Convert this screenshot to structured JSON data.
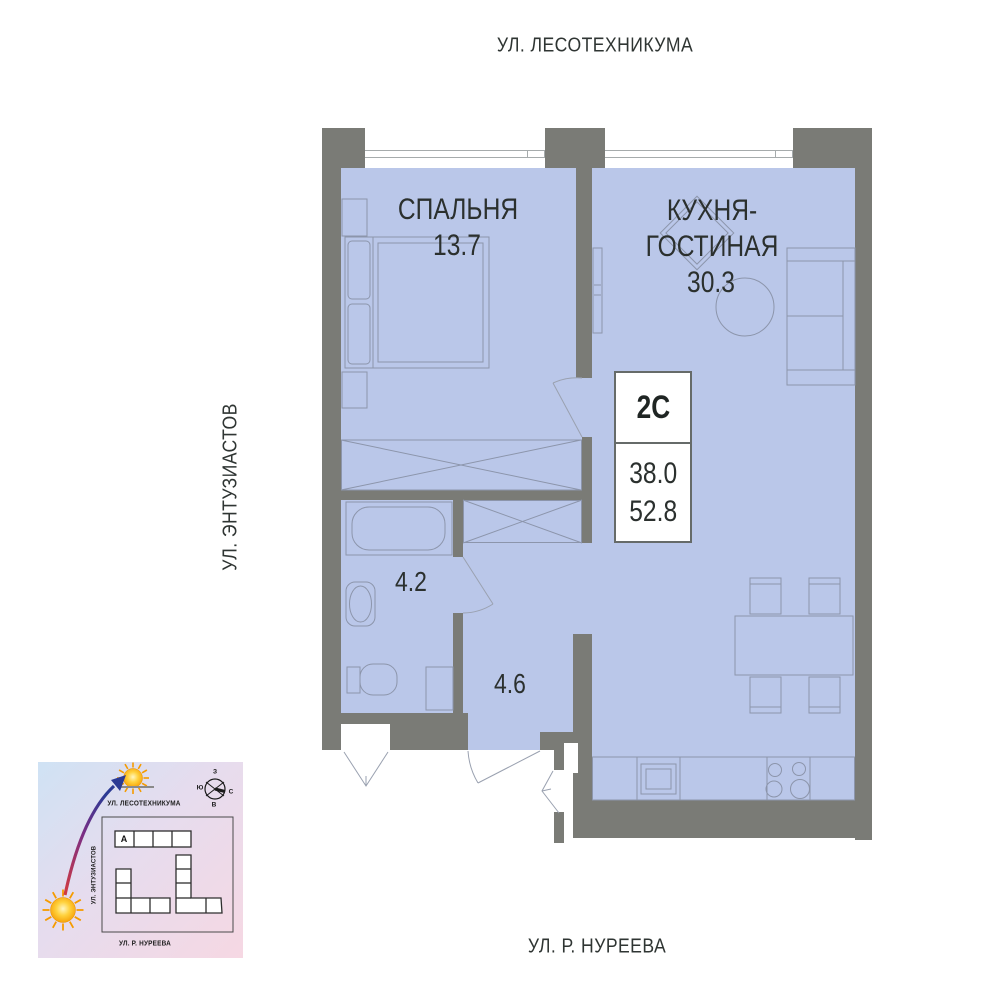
{
  "streets": {
    "top": "УЛ. ЛЕСОТЕХНИКУМА",
    "left": "УЛ. ЭНТУЗИАСТОВ",
    "bottom": "УЛ. Р. НУРЕЕВА"
  },
  "rooms": {
    "bedroom_name": "СПАЛЬНЯ",
    "bedroom_area": "13.7",
    "kitchen_name1": "КУХНЯ-",
    "kitchen_name2": "ГОСТИНАЯ",
    "kitchen_area": "30.3",
    "bathroom_area": "4.2",
    "hallway_area": "4.6"
  },
  "info": {
    "unit_type": "2С",
    "living_area": "38.0",
    "total_area": "52.8"
  },
  "minimap": {
    "street_top": "УЛ. ЛЕСОТЕХНИКУМА",
    "street_left": "УЛ. ЭНТУЗИАСТОВ",
    "street_bottom": "УЛ. Р. НУРЕЕВА",
    "building": "А",
    "compass_top": "З",
    "compass_left": "Ю",
    "compass_right": "С",
    "compass_bottom": "В"
  },
  "colors": {
    "floor": "#bac7e9",
    "wall": "#7a7b76",
    "furniture_line": "#8c95ab",
    "text": "#2b302e",
    "sun": "#f59b00",
    "arrow_start": "#d23b40",
    "arrow_end": "#2b3a94"
  }
}
